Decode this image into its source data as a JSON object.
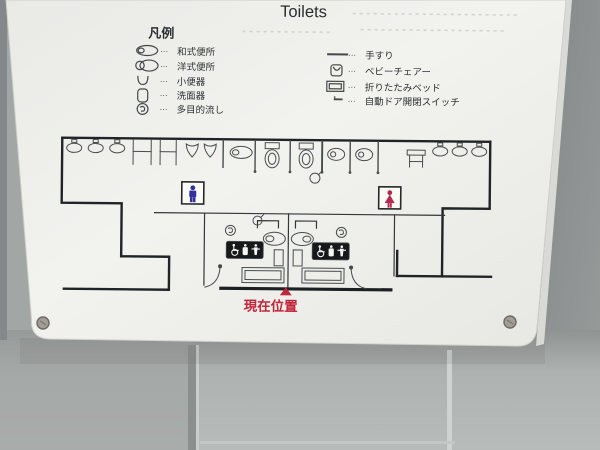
{
  "sign": {
    "title": "Toilets",
    "legend": {
      "header": "凡例",
      "separator": "···",
      "left_items": [
        {
          "icon": "squat-toilet-icon",
          "label": "和式便所"
        },
        {
          "icon": "western-toilet-icon",
          "label": "洋式便所"
        },
        {
          "icon": "urinal-icon",
          "label": "小便器"
        },
        {
          "icon": "washbasin-icon",
          "label": "洗面器"
        },
        {
          "icon": "multipurpose-sink-icon",
          "label": "多目的流し"
        }
      ],
      "right_items": [
        {
          "icon": "handrail-icon",
          "label": "手すり"
        },
        {
          "icon": "baby-chair-icon",
          "label": "ベビーチェアー"
        },
        {
          "icon": "folding-bed-icon",
          "label": "折りたたみベッド"
        },
        {
          "icon": "auto-door-switch-icon",
          "label": "自動ドア開閉スイッチ"
        }
      ]
    },
    "map": {
      "current_location_label": "現在位置",
      "mens_symbol": "male-pictogram",
      "womens_symbol": "female-pictogram"
    },
    "colors": {
      "male_blue": "#31339b",
      "female_red": "#b52a4e",
      "location_red": "#c0273d",
      "line_dark": "#27292b",
      "panel_white": "#f1f1ee",
      "wall_gray": "#a2a6a4"
    }
  }
}
